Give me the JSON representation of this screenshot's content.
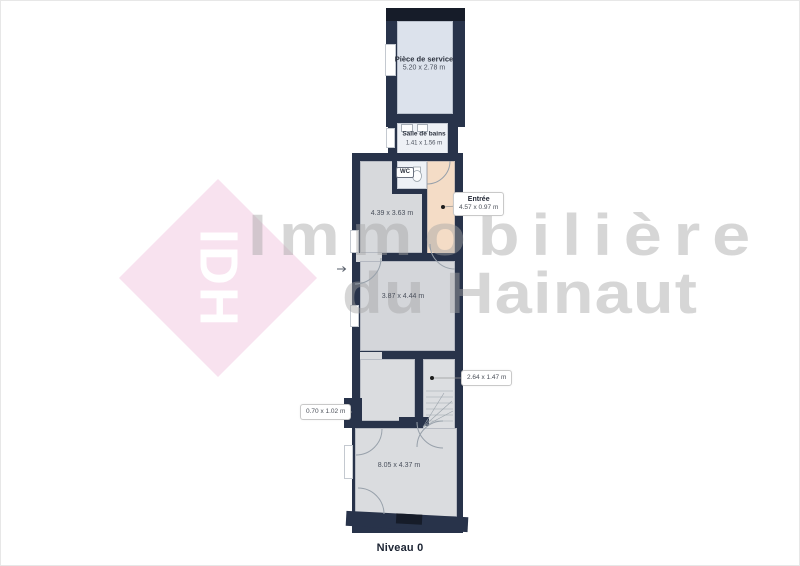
{
  "brand": {
    "logo_text": "IDH",
    "watermark_line1": "Immobilière",
    "watermark_line2": "du Hainaut"
  },
  "floor_label": "Niveau 0",
  "rooms": {
    "service": {
      "name": "Pièce de service",
      "dims": "5.20 x 2.78 m"
    },
    "bath": {
      "name": "Salle de bains",
      "dims": "1.41 x 1.56 m"
    },
    "wc": {
      "name": "WC"
    },
    "room1": {
      "dims": "4.39 x 3.63 m"
    },
    "room2": {
      "dims": "3.87 x 4.44 m"
    },
    "room3": {
      "dims": "8.05 x 4.37 m"
    }
  },
  "callouts": {
    "entree": {
      "title": "Entrée",
      "dims": "4.57 x 0.97 m"
    },
    "stairwell": {
      "dims": "2.64 x 1.47 m"
    },
    "closet": {
      "dims": "0.70 x 1.02 m"
    }
  },
  "colors": {
    "wall": "#28334a",
    "wall_dark": "#161c29",
    "room_blue": "#dce2ec",
    "room_gray": "#d6d8db",
    "corridor_peach": "#f4dcc6",
    "bath_white": "#eef1f6",
    "diamond_pink": "#f8e2ef"
  }
}
